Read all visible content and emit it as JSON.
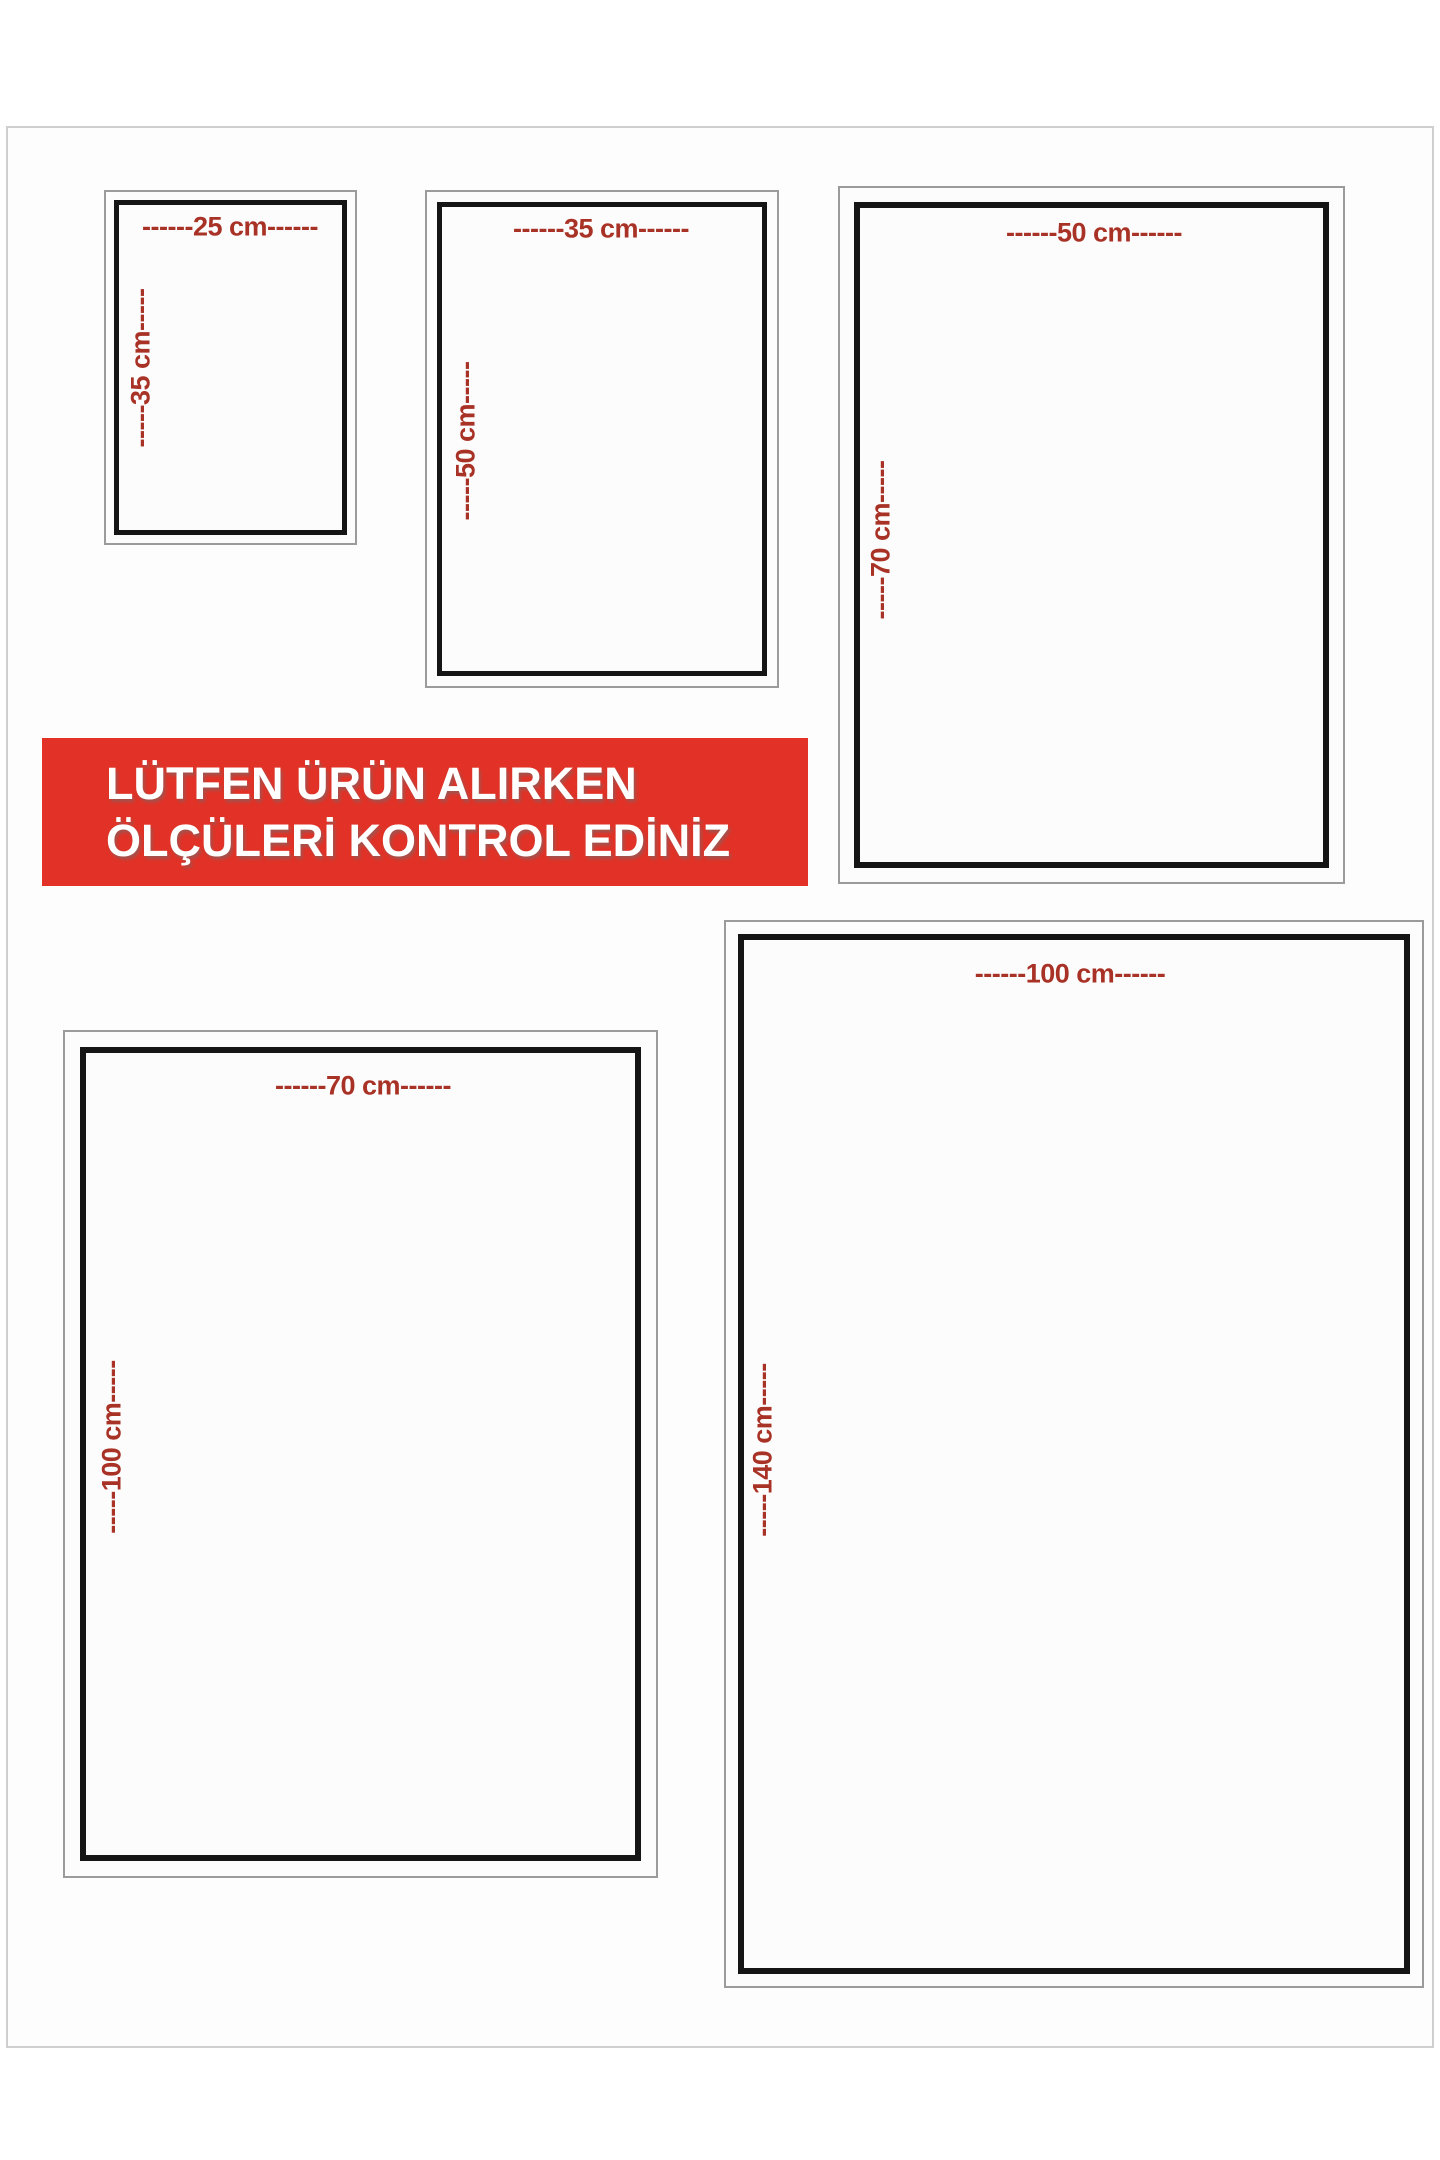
{
  "banner": {
    "line1": "LÜTFEN ÜRÜN ALIRKEN",
    "line2": "ÖLÇÜLERİ KONTROL EDİNİZ",
    "background": "#e23227",
    "text_color": "#ffffff"
  },
  "colors": {
    "label_red": "#a93226",
    "inner_frame_black": "#151515",
    "outer_frame_gray": "#9b9b9b",
    "page_edge_gray": "#cfcfcf",
    "background": "#ffffff"
  },
  "sizes": [
    {
      "id": "25x35",
      "width_cm": 25,
      "height_cm": 35,
      "width_label": "------25 cm------",
      "height_label": "-----35 cm-----"
    },
    {
      "id": "35x50",
      "width_cm": 35,
      "height_cm": 50,
      "width_label": "------35 cm------",
      "height_label": "-----50 cm-----"
    },
    {
      "id": "50x70",
      "width_cm": 50,
      "height_cm": 70,
      "width_label": "------50 cm------",
      "height_label": "-----70 cm-----"
    },
    {
      "id": "70x100",
      "width_cm": 70,
      "height_cm": 100,
      "width_label": "------70 cm------",
      "height_label": "-----100 cm-----"
    },
    {
      "id": "100x140",
      "width_cm": 100,
      "height_cm": 140,
      "width_label": "------100 cm------",
      "height_label": "-----140 cm-----"
    }
  ]
}
